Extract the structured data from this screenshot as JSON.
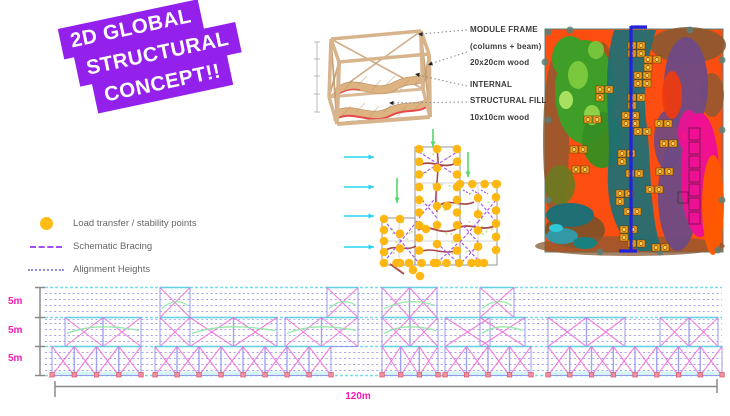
{
  "title": {
    "lines": [
      "2D GLOBAL",
      "STRUCTURAL",
      "CONCEPT!!"
    ]
  },
  "module_diagram": {
    "annotations": [
      {
        "lines": [
          "MODULE FRAME",
          "(columns + beam)",
          "20x20cm wood"
        ]
      },
      {
        "lines": [
          "INTERNAL",
          "STRUCTURAL FILL",
          "10x10cm wood"
        ]
      }
    ]
  },
  "legend": {
    "items": [
      {
        "label": "Load transfer / stability points",
        "marker": "dot"
      },
      {
        "label": "Schematic Bracing",
        "marker": "dash"
      },
      {
        "label": "Alignment Heights",
        "marker": "dotted"
      }
    ]
  },
  "elevation": {
    "height_labels": [
      "5m",
      "5m",
      "5m"
    ],
    "width_label": "120m"
  },
  "colors": {
    "title_bg": "#9320EB",
    "title_fg": "#FFFFFF",
    "dim_magenta": "#F81CB5",
    "legend_dot": "#FFBB16",
    "bracing_purple": "#A24DF0",
    "alignment_line": "#8F8FE8",
    "elev_pink": "#F06AD8",
    "elev_cyan": "#5FD8E4",
    "elev_green": "#8CE8A0",
    "elev_column": "#9898EE",
    "elev_base_node": "#F2909E",
    "plan_dot": "#FFB714",
    "plan_grid": "#A8A8A8",
    "plan_wall": "#A84848",
    "plan_green": "#9ACD32",
    "arrow_cyan": "#25D5F2",
    "arrow_green": "#52D96A",
    "wood": "#D8B48C",
    "wood_dark": "#C49A6C",
    "slab": "#DCB381",
    "slab_red": "#E84848",
    "leader_grey": "#888888",
    "dim_grey": "#8A8A8A",
    "map_bg": "#FB4E10",
    "map_green": "#3E9E28",
    "map_green_light": "#7AC83E",
    "map_teal": "#1F6F74",
    "map_purple": "#6E4A85",
    "map_magenta": "#EF0F96",
    "map_brown": "#8A5A32",
    "map_orange": "#FF5A00",
    "map_cluster": "#F7A61C",
    "map_cluster_dot": "#FFCE4F",
    "section_blue": "#2222DD"
  }
}
